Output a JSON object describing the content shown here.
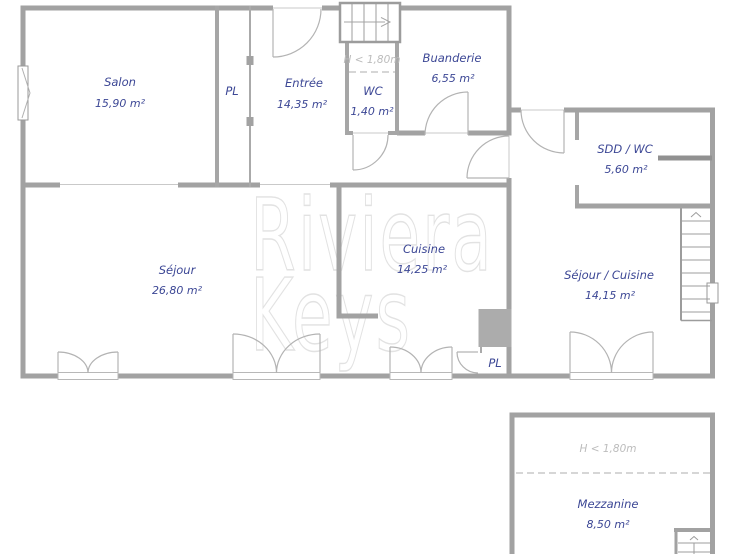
{
  "watermark": {
    "line1": "Riviera",
    "line2": "Keys"
  },
  "rooms": {
    "salon": {
      "name": "Salon",
      "area": "15,90 m²"
    },
    "pl_hall": {
      "name": "PL"
    },
    "entree": {
      "name": "Entrée",
      "area": "14,35 m²"
    },
    "wc": {
      "name": "WC",
      "area": "1,40 m²",
      "note": "H < 1,80m"
    },
    "buanderie": {
      "name": "Buanderie",
      "area": "6,55 m²"
    },
    "sejour": {
      "name": "Séjour",
      "area": "26,80 m²"
    },
    "cuisine": {
      "name": "Cuisine",
      "area": "14,25 m²"
    },
    "pl_cuisine": {
      "name": "PL"
    },
    "sdd_wc": {
      "name": "SDD / WC",
      "area": "5,60 m²"
    },
    "sejour_cuisine": {
      "name": "Séjour / Cuisine",
      "area": "14,15 m²"
    },
    "mezzanine": {
      "name": "Mezzanine",
      "area": "8,50 m²",
      "note": "H < 1,80m"
    }
  },
  "colors": {
    "wall": "#a2a2a2",
    "label_blue": "#3c4795",
    "note_gray": "#bcbcbc",
    "watermark_gray": "#e2e2e2"
  }
}
